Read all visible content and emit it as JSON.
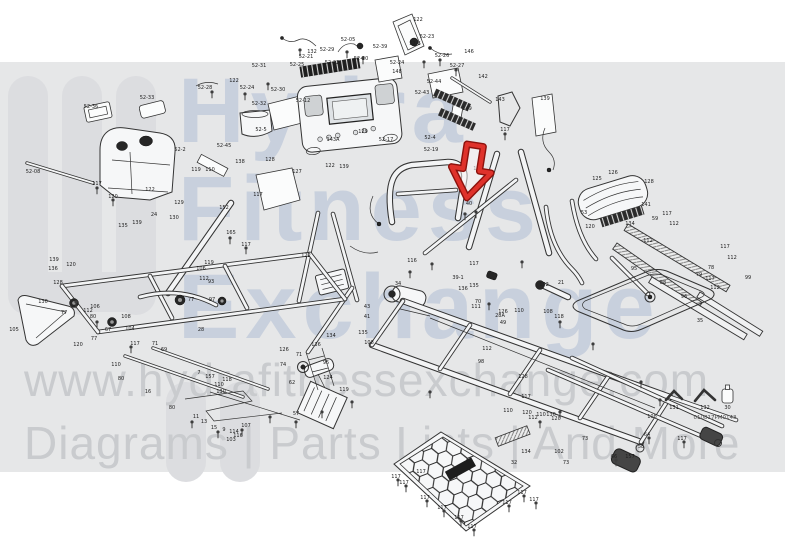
{
  "watermark": {
    "logo_lines": [
      "Hydra",
      "Fitness",
      "Exchange"
    ],
    "url": "www.hydrafitnessexchange.com",
    "tagline": "Diagrams | Parts Lists | And More",
    "band_color": "#e6e7e8",
    "logo_color": "#dcdde0",
    "small_text_color": "#c9cbce",
    "big_text_color": "#98acc8"
  },
  "diagram": {
    "type": "treadmill-exploded-parts-diagram",
    "drawing_code": "010817PM0143",
    "tools": [
      {
        "label": "131",
        "icon": "allen-wrench-icon"
      },
      {
        "label": "132",
        "icon": "allen-wrench-icon"
      },
      {
        "label": "30",
        "icon": "lubricant-bottle-icon"
      }
    ],
    "annotation": {
      "type": "red-arrow",
      "color": "#df322b",
      "outline": "#8c120d",
      "transform": "translate(470,178) rotate(9) scale(1.18)",
      "points_to": "40"
    },
    "callouts": [
      [
        "52-05",
        348,
        41
      ],
      [
        "132",
        312,
        53
      ],
      [
        "52-29",
        327,
        51
      ],
      [
        "52-21",
        306,
        58
      ],
      [
        "52-22",
        332,
        64
      ],
      [
        "52-25",
        297,
        66
      ],
      [
        "52-20",
        361,
        60
      ],
      [
        "52-24",
        397,
        64
      ],
      [
        "52-39",
        380,
        48
      ],
      [
        "52-23",
        427,
        38
      ],
      [
        "122",
        418,
        21
      ],
      [
        "52-6",
        415,
        45
      ],
      [
        "52-26",
        442,
        57
      ],
      [
        "52-27",
        457,
        67
      ],
      [
        "146",
        469,
        53
      ],
      [
        "52-44",
        434,
        83
      ],
      [
        "52-43",
        422,
        94
      ],
      [
        "142",
        483,
        78
      ],
      [
        "148",
        397,
        73
      ],
      [
        "52-31",
        259,
        67
      ],
      [
        "52-28",
        205,
        89
      ],
      [
        "122",
        234,
        82
      ],
      [
        "52-24",
        247,
        89
      ],
      [
        "52-30",
        278,
        91
      ],
      [
        "52-32",
        259,
        105
      ],
      [
        "52-12",
        303,
        102
      ],
      [
        "52-5",
        261,
        131
      ],
      [
        "52-33",
        147,
        99
      ],
      [
        "52-36",
        91,
        108
      ],
      [
        "52-08",
        33,
        173
      ],
      [
        "52-2",
        180,
        151
      ],
      [
        "52-45",
        224,
        147
      ],
      [
        "143",
        500,
        101
      ],
      [
        "139",
        545,
        100
      ],
      [
        "149",
        467,
        110
      ],
      [
        "117",
        505,
        131
      ],
      [
        "52-17",
        386,
        141
      ],
      [
        "129",
        363,
        133
      ],
      [
        "143A",
        333,
        141
      ],
      [
        "122",
        330,
        167
      ],
      [
        "139",
        344,
        168
      ],
      [
        "52-4",
        430,
        139
      ],
      [
        "52-19",
        431,
        151
      ],
      [
        "119",
        196,
        171
      ],
      [
        "110",
        210,
        171
      ],
      [
        "117",
        97,
        185
      ],
      [
        "120",
        113,
        198
      ],
      [
        "122",
        150,
        191
      ],
      [
        "130",
        174,
        219
      ],
      [
        "129",
        179,
        204
      ],
      [
        "135",
        123,
        227
      ],
      [
        "139",
        137,
        224
      ],
      [
        "24",
        154,
        216
      ],
      [
        "152",
        224,
        209
      ],
      [
        "165",
        231,
        234
      ],
      [
        "117",
        246,
        246
      ],
      [
        "138",
        240,
        163
      ],
      [
        "127",
        297,
        173
      ],
      [
        "128",
        270,
        161
      ],
      [
        "117",
        258,
        196
      ],
      [
        "115",
        478,
        170
      ],
      [
        "40",
        469,
        205
      ],
      [
        "122",
        306,
        257
      ],
      [
        "116",
        412,
        262
      ],
      [
        "125",
        597,
        180
      ],
      [
        "126",
        613,
        174
      ],
      [
        "128",
        649,
        183
      ],
      [
        "120",
        590,
        228
      ],
      [
        "53",
        584,
        214
      ],
      [
        "141",
        646,
        206
      ],
      [
        "59",
        655,
        220
      ],
      [
        "117",
        667,
        215
      ],
      [
        "112",
        674,
        225
      ],
      [
        "134",
        630,
        225
      ],
      [
        "112",
        648,
        242
      ],
      [
        "117",
        725,
        248
      ],
      [
        "112",
        732,
        259
      ],
      [
        "78",
        711,
        269
      ],
      [
        "79",
        699,
        276
      ],
      [
        "117",
        710,
        280
      ],
      [
        "112",
        715,
        289
      ],
      [
        "95",
        634,
        270
      ],
      [
        "88",
        663,
        284
      ],
      [
        "96",
        684,
        298
      ],
      [
        "99",
        748,
        279
      ],
      [
        "35",
        700,
        322
      ],
      [
        "34",
        398,
        285
      ],
      [
        "43",
        367,
        308
      ],
      [
        "41",
        367,
        318
      ],
      [
        "117",
        474,
        265
      ],
      [
        "135",
        474,
        287
      ],
      [
        "39-1",
        458,
        279
      ],
      [
        "136",
        463,
        290
      ],
      [
        "70",
        478,
        303
      ],
      [
        "28A",
        500,
        317
      ],
      [
        "126",
        503,
        313
      ],
      [
        "49",
        503,
        324
      ],
      [
        "110",
        519,
        312
      ],
      [
        "108",
        548,
        313
      ],
      [
        "118",
        559,
        318
      ],
      [
        "128",
        523,
        378
      ],
      [
        "98",
        481,
        363
      ],
      [
        "112",
        487,
        350
      ],
      [
        "117",
        526,
        398
      ],
      [
        "111",
        476,
        308
      ],
      [
        "21",
        561,
        284
      ],
      [
        "152",
        544,
        286
      ],
      [
        "119",
        344,
        391
      ],
      [
        "126",
        284,
        351
      ],
      [
        "136",
        316,
        346
      ],
      [
        "134",
        331,
        337
      ],
      [
        "95",
        326,
        364
      ],
      [
        "71",
        299,
        356
      ],
      [
        "74",
        283,
        366
      ],
      [
        "62",
        292,
        384
      ],
      [
        "124",
        328,
        379
      ],
      [
        "135",
        363,
        334
      ],
      [
        "108",
        369,
        344
      ],
      [
        "136",
        53,
        270
      ],
      [
        "139",
        54,
        261
      ],
      [
        "120",
        71,
        266
      ],
      [
        "128",
        58,
        284
      ],
      [
        "105",
        14,
        331
      ],
      [
        "130",
        43,
        303
      ],
      [
        "120",
        78,
        346
      ],
      [
        "77",
        64,
        314
      ],
      [
        "112",
        88,
        312
      ],
      [
        "80",
        93,
        318
      ],
      [
        "106",
        95,
        308
      ],
      [
        "104",
        130,
        330
      ],
      [
        "67",
        108,
        331
      ],
      [
        "77",
        94,
        340
      ],
      [
        "117",
        135,
        345
      ],
      [
        "108",
        126,
        318
      ],
      [
        "28",
        201,
        331
      ],
      [
        "71",
        155,
        345
      ],
      [
        "69",
        164,
        351
      ],
      [
        "97",
        212,
        301
      ],
      [
        "93",
        211,
        283
      ],
      [
        "106",
        201,
        270
      ],
      [
        "112",
        204,
        280
      ],
      [
        "77",
        191,
        301
      ],
      [
        "119",
        209,
        264
      ],
      [
        "110",
        116,
        366
      ],
      [
        "80",
        121,
        380
      ],
      [
        "16",
        148,
        393
      ],
      [
        "157",
        210,
        378
      ],
      [
        "118",
        227,
        381
      ],
      [
        "7",
        199,
        374
      ],
      [
        "130",
        221,
        393
      ],
      [
        "80",
        172,
        409
      ],
      [
        "11",
        196,
        418
      ],
      [
        "13",
        204,
        423
      ],
      [
        "15",
        214,
        429
      ],
      [
        "9",
        224,
        431
      ],
      [
        "107",
        246,
        427
      ],
      [
        "114",
        234,
        433
      ],
      [
        "116",
        238,
        437
      ],
      [
        "103",
        231,
        441
      ],
      [
        "57",
        296,
        415
      ],
      [
        "110",
        219,
        386
      ],
      [
        "32",
        514,
        464
      ],
      [
        "134",
        526,
        453
      ],
      [
        "130",
        551,
        416
      ],
      [
        "120",
        556,
        420
      ],
      [
        "110",
        541,
        416
      ],
      [
        "102",
        559,
        453
      ],
      [
        "73",
        566,
        464
      ],
      [
        "117",
        396,
        478
      ],
      [
        "117",
        404,
        484
      ],
      [
        "117",
        425,
        499
      ],
      [
        "117",
        442,
        509
      ],
      [
        "117",
        459,
        519
      ],
      [
        "117",
        472,
        528
      ],
      [
        "117",
        507,
        504
      ],
      [
        "117",
        522,
        494
      ],
      [
        "117",
        534,
        501
      ],
      [
        "117",
        421,
        473
      ],
      [
        "108",
        652,
        418
      ],
      [
        "117",
        682,
        440
      ],
      [
        "64",
        647,
        436
      ],
      [
        "58",
        641,
        448
      ],
      [
        "157",
        630,
        458
      ],
      [
        "66",
        614,
        458
      ],
      [
        "73",
        585,
        440
      ],
      [
        "112",
        533,
        419
      ],
      [
        "120",
        527,
        414
      ],
      [
        "110",
        508,
        412
      ]
    ]
  }
}
